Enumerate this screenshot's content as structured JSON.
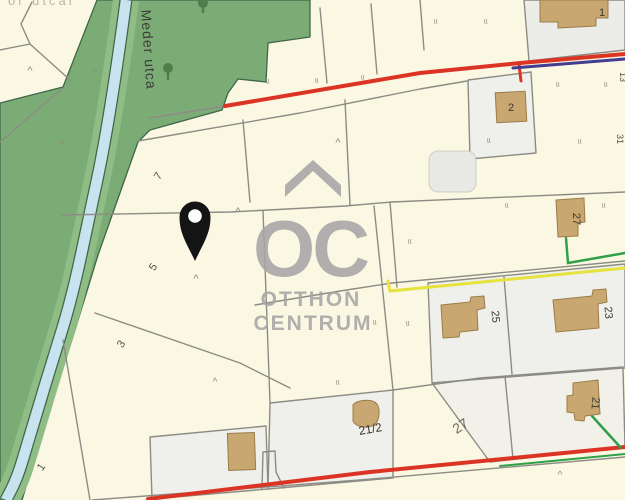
{
  "map": {
    "street_name": "Meder utca",
    "corner_partial_text": "or utcai",
    "watermark": {
      "oc": "OC",
      "line1": "OTTHON",
      "line2": "CENTRUM"
    },
    "pin": {
      "x": 195,
      "y": 217
    }
  },
  "colors": {
    "parcel_cream": "#FAF8E3",
    "parcel_white": "#EFEFEB",
    "parcel_grey": "#ECECE8",
    "boundary_grey": "#8C8C84",
    "vegetation": "#7CAC76",
    "vegetation_band": "#8FBD85",
    "stream_water": "#C7E3EF",
    "stream_edge": "#3F6647",
    "road_red": "#DC3424",
    "line_purple": "#423C92",
    "line_yellow": "#E6E33C",
    "line_green": "#2FA048",
    "building_tan": "#C9A770",
    "building_edge": "#9C7C49",
    "watermark_grey": "#A6A6A6",
    "pin_black": "#141414"
  },
  "labels": [
    {
      "n": "street-label",
      "text": "Meder utca",
      "x": 141,
      "y": 10,
      "r": 86,
      "s": 14,
      "f": "#3c3c38",
      "ls": 1,
      "a": "start"
    },
    {
      "n": "corner-partial-label",
      "text": "or utcai",
      "x": 8,
      "y": 5,
      "s": 13,
      "f": "#9a9a90",
      "ls": 3,
      "a": "start",
      "o": 0.7
    },
    {
      "n": "parcel-number",
      "text": "7",
      "x": 161,
      "y": 178,
      "r": -55,
      "s": 11,
      "f": "#55524a"
    },
    {
      "n": "parcel-number",
      "text": "5",
      "x": 156,
      "y": 269,
      "r": -55,
      "s": 11,
      "f": "#55524a"
    },
    {
      "n": "parcel-number",
      "text": "3",
      "x": 124,
      "y": 346,
      "r": -55,
      "s": 11,
      "f": "#55524a"
    },
    {
      "n": "parcel-number",
      "text": "1",
      "x": 44,
      "y": 469,
      "r": -55,
      "s": 11,
      "f": "#55524a"
    },
    {
      "n": "house-number",
      "text": "1",
      "x": 602,
      "y": 16,
      "s": 11,
      "f": "#3a382f"
    },
    {
      "n": "house-number",
      "text": "2",
      "x": 511,
      "y": 111,
      "s": 11,
      "f": "#3a382f"
    },
    {
      "n": "house-number",
      "text": "27",
      "x": 573,
      "y": 219,
      "r": 90,
      "s": 11,
      "f": "#3a382f"
    },
    {
      "n": "house-number",
      "text": "25",
      "x": 492,
      "y": 317,
      "r": 85,
      "s": 11,
      "f": "#3a382f"
    },
    {
      "n": "house-number",
      "text": "23",
      "x": 605,
      "y": 313,
      "r": 85,
      "s": 11,
      "f": "#3a382f"
    },
    {
      "n": "house-number",
      "text": "21/2",
      "x": 371,
      "y": 433,
      "r": -10,
      "s": 12,
      "f": "#3a382f"
    },
    {
      "n": "house-number",
      "text": "21",
      "x": 592,
      "y": 403,
      "r": 95,
      "s": 11,
      "f": "#3a382f"
    },
    {
      "n": "parcel-number",
      "text": "27",
      "x": 463,
      "y": 430,
      "r": -33,
      "s": 14,
      "f": "#6a675e"
    },
    {
      "n": "house-number",
      "text": "13",
      "x": 620,
      "y": 77,
      "r": 90,
      "s": 9,
      "f": "#55524a"
    },
    {
      "n": "house-number",
      "text": "31",
      "x": 617,
      "y": 139,
      "r": 90,
      "s": 9,
      "f": "#55524a"
    },
    {
      "n": "gate-mark",
      "text": "II",
      "x": 268,
      "y": 84,
      "s": 7,
      "f": "#8a8a7f",
      "r": -8
    },
    {
      "n": "gate-mark",
      "text": "II",
      "x": 317,
      "y": 83,
      "s": 7,
      "f": "#8a8a7f",
      "r": -8
    },
    {
      "n": "gate-mark",
      "text": "II",
      "x": 363,
      "y": 80,
      "s": 7,
      "f": "#8a8a7f",
      "r": -8
    },
    {
      "n": "gate-mark",
      "text": "II",
      "x": 436,
      "y": 24,
      "s": 7,
      "f": "#8a8a7f",
      "r": -8
    },
    {
      "n": "gate-mark",
      "text": "II",
      "x": 486,
      "y": 24,
      "s": 7,
      "f": "#8a8a7f",
      "r": -8
    },
    {
      "n": "gate-mark",
      "text": "II",
      "x": 558,
      "y": 87,
      "s": 7,
      "f": "#8a8a7f",
      "r": -8
    },
    {
      "n": "gate-mark",
      "text": "II",
      "x": 606,
      "y": 87,
      "s": 7,
      "f": "#8a8a7f",
      "r": -8
    },
    {
      "n": "gate-mark",
      "text": "II",
      "x": 580,
      "y": 144,
      "s": 7,
      "f": "#8a8a7f",
      "r": -8
    },
    {
      "n": "gate-mark",
      "text": "II",
      "x": 489,
      "y": 143,
      "s": 7,
      "f": "#8a8a7f",
      "r": -8
    },
    {
      "n": "gate-mark",
      "text": "II",
      "x": 507,
      "y": 208,
      "s": 7,
      "f": "#8a8a7f",
      "r": -8
    },
    {
      "n": "gate-mark",
      "text": "II",
      "x": 604,
      "y": 208,
      "s": 7,
      "f": "#8a8a7f",
      "r": -8
    },
    {
      "n": "gate-mark",
      "text": "II",
      "x": 410,
      "y": 244,
      "s": 7,
      "f": "#8a8a7f",
      "r": -8
    },
    {
      "n": "gate-mark",
      "text": "II",
      "x": 408,
      "y": 326,
      "s": 7,
      "f": "#8a8a7f",
      "r": -8
    },
    {
      "n": "gate-mark",
      "text": "II",
      "x": 338,
      "y": 385,
      "s": 7,
      "f": "#8a8a7f",
      "r": -8
    },
    {
      "n": "gate-mark",
      "text": "II",
      "x": 375,
      "y": 325,
      "s": 7,
      "f": "#8a8a7f",
      "r": -8
    },
    {
      "n": "caret-mark",
      "text": "^",
      "x": 30,
      "y": 74,
      "s": 11,
      "f": "#8a8a7f"
    },
    {
      "n": "caret-mark",
      "text": "^",
      "x": 95,
      "y": 76,
      "s": 11,
      "f": "#8a8a7f"
    },
    {
      "n": "caret-mark",
      "text": "^",
      "x": 62,
      "y": 148,
      "s": 11,
      "f": "#8a8a7f"
    },
    {
      "n": "caret-mark",
      "text": "^",
      "x": 196,
      "y": 282,
      "s": 11,
      "f": "#8a8a7f"
    },
    {
      "n": "caret-mark",
      "text": "^",
      "x": 338,
      "y": 146,
      "s": 11,
      "f": "#8a8a7f"
    },
    {
      "n": "caret-mark",
      "text": "^",
      "x": 238,
      "y": 215,
      "s": 11,
      "f": "#8a8a7f"
    },
    {
      "n": "caret-mark",
      "text": "^",
      "x": 215,
      "y": 385,
      "s": 10,
      "f": "#8a8a7f"
    },
    {
      "n": "caret-mark",
      "text": "^",
      "x": 560,
      "y": 478,
      "s": 10,
      "f": "#8a8a7f"
    }
  ]
}
